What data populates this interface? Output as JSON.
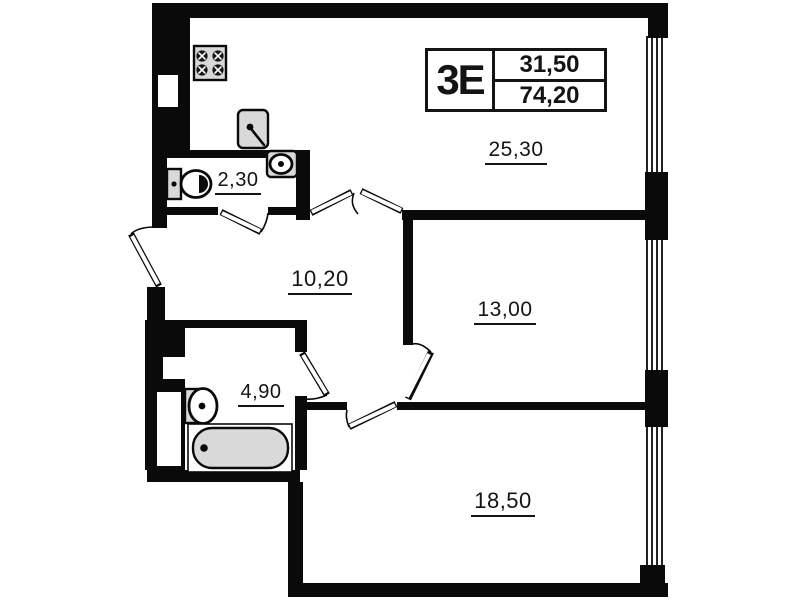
{
  "unit": {
    "type_label": "3Е",
    "living_area": "31,50",
    "total_area": "74,20"
  },
  "rooms": {
    "kitchen_living": "25,30",
    "wc": "2,30",
    "hallway": "10,20",
    "bedroom": "13,00",
    "bathroom": "4,90",
    "living_room": "18,50"
  },
  "colors": {
    "wall": "#0a0a0a",
    "fixture": "#d9d9d9",
    "background": "#ffffff"
  }
}
